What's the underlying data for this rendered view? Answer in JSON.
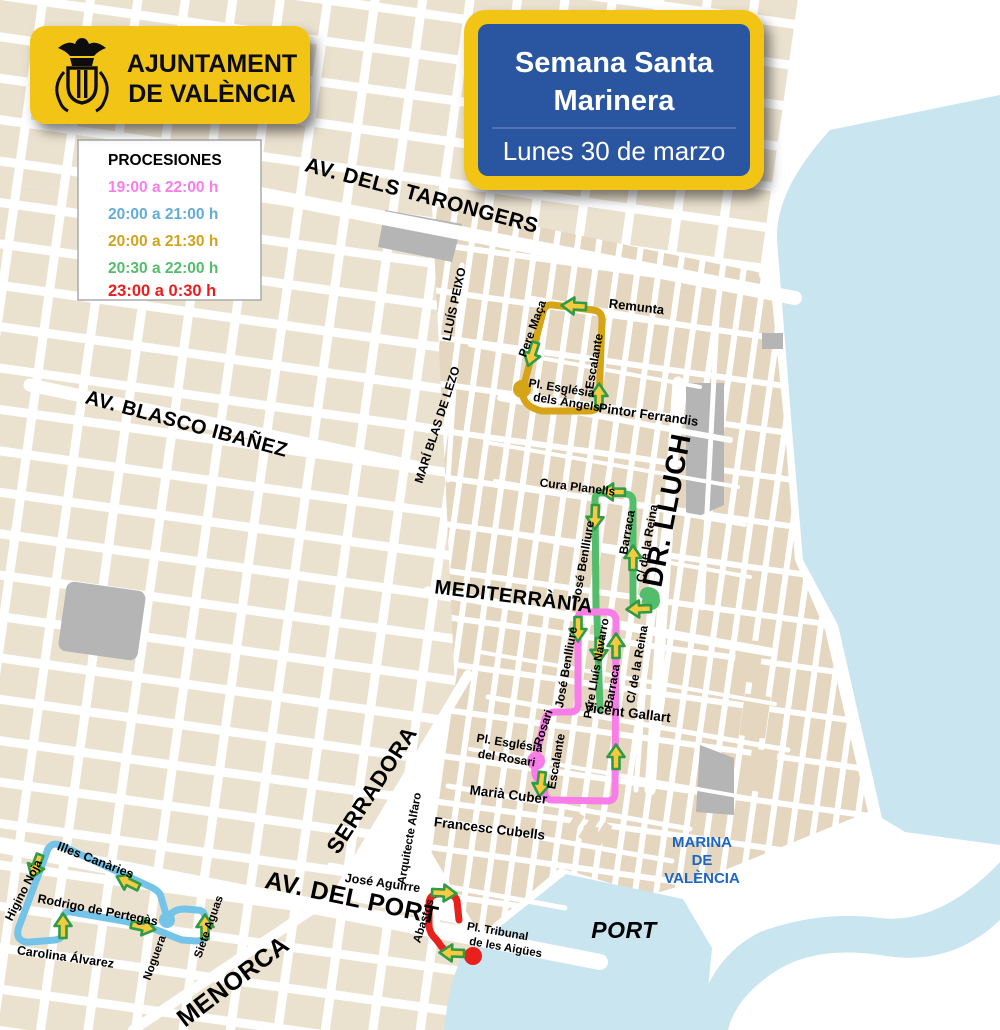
{
  "header": {
    "municipality": {
      "line1": "AJUNTAMENT",
      "line2": "DE VALÈNCIA"
    },
    "event": {
      "title_line1": "Semana Santa",
      "title_line2": "Marinera",
      "date": "Lunes 30 de marzo"
    },
    "badge_yellow": "#F2C417",
    "badge_blue": "#2A55A0"
  },
  "legend": {
    "title": "PROCESIONES",
    "items": [
      {
        "label": "19:00 a 22:00 h",
        "color": "#F97DE9"
      },
      {
        "label": "20:00 a 21:00 h",
        "color": "#63ACD8"
      },
      {
        "label": "20:00 a 21:30 h",
        "color": "#D2A31D"
      },
      {
        "label": "20:30 a 22:00 h",
        "color": "#55BC6C"
      },
      {
        "label": "23:00 a 0:30 h",
        "color": "#EC1C1C"
      }
    ]
  },
  "map": {
    "arrow": {
      "fill": "#F9C93F",
      "stroke": "#2F9B44"
    },
    "land_color": "#E4D6BF",
    "left_land_color": "#EBE1CF",
    "water_color": "#C9E5EF",
    "gray_block_color": "#B5B5B5",
    "major_streets": [
      {
        "label": "AV. DELS TARONGERS"
      },
      {
        "label": "AV. BLASCO IBAÑEZ"
      },
      {
        "label": "MEDITERRÀNIA"
      },
      {
        "label": "DR. LLUCH"
      },
      {
        "label": "SERRADORA"
      },
      {
        "label": "AV. DEL PORT"
      },
      {
        "label": "MENORCA"
      }
    ],
    "street_labels": [
      {
        "label": "Remunta"
      },
      {
        "label": "Pere Maça"
      },
      {
        "label": "Escalante"
      },
      {
        "label": "Pintor Ferrandis"
      },
      {
        "label": "LLUÍS PEIXO"
      },
      {
        "label": "MARÍ BLAS DE LEZO"
      },
      {
        "label": "Cura Planells"
      },
      {
        "label": "José Benlliure"
      },
      {
        "label": "Barraca"
      },
      {
        "label": "C/ de la Reina"
      },
      {
        "label": "José Benlliure"
      },
      {
        "label": "Pare Lluís Navarro"
      },
      {
        "label": "Barraca"
      },
      {
        "label": "C/ de la Reina"
      },
      {
        "label": "Vicent Gallart"
      },
      {
        "label": "Rosari"
      },
      {
        "label": "Escalante"
      },
      {
        "label": "Marià Cuber"
      },
      {
        "label": "Francesc Cubells"
      },
      {
        "label": "José Aguirre"
      },
      {
        "label": "Arquitecte Alfaro"
      },
      {
        "label": "Abastos"
      },
      {
        "label": "Illes Canàries"
      },
      {
        "label": "Higino Noja"
      },
      {
        "label": "Rodrigo de Pertegàs"
      },
      {
        "label": "Carolina Álvarez"
      },
      {
        "label": "Noguera"
      },
      {
        "label": "Siete Aguas"
      }
    ],
    "places": [
      {
        "line1": "Pl. Església",
        "line2": "dels Àngels"
      },
      {
        "line1": "Pl. Església",
        "line2": "del Rosari"
      },
      {
        "line1": "Pl. Tribunal",
        "line2": "de les Aigües"
      }
    ],
    "water": {
      "marina_line1": "MARINA",
      "marina_line2": "DE",
      "marina_line3": "VALÈNCIA",
      "marina_color": "#1A66C7",
      "port": "PORT"
    },
    "routes": [
      {
        "name": "route-1900-2200",
        "time": "19:00 a 22:00 h",
        "color": "#F97DE9"
      },
      {
        "name": "route-2000-2100",
        "time": "20:00 a 21:00 h",
        "color": "#74C3E8"
      },
      {
        "name": "route-2000-2130",
        "time": "20:00 a 21:30 h",
        "color": "#D5A417"
      },
      {
        "name": "route-2030-2200",
        "time": "20:30 a 22:00 h",
        "color": "#53BD6C"
      },
      {
        "name": "route-2300-0030",
        "time": "23:00 a 0:30 h",
        "color": "#E8211D"
      }
    ]
  }
}
